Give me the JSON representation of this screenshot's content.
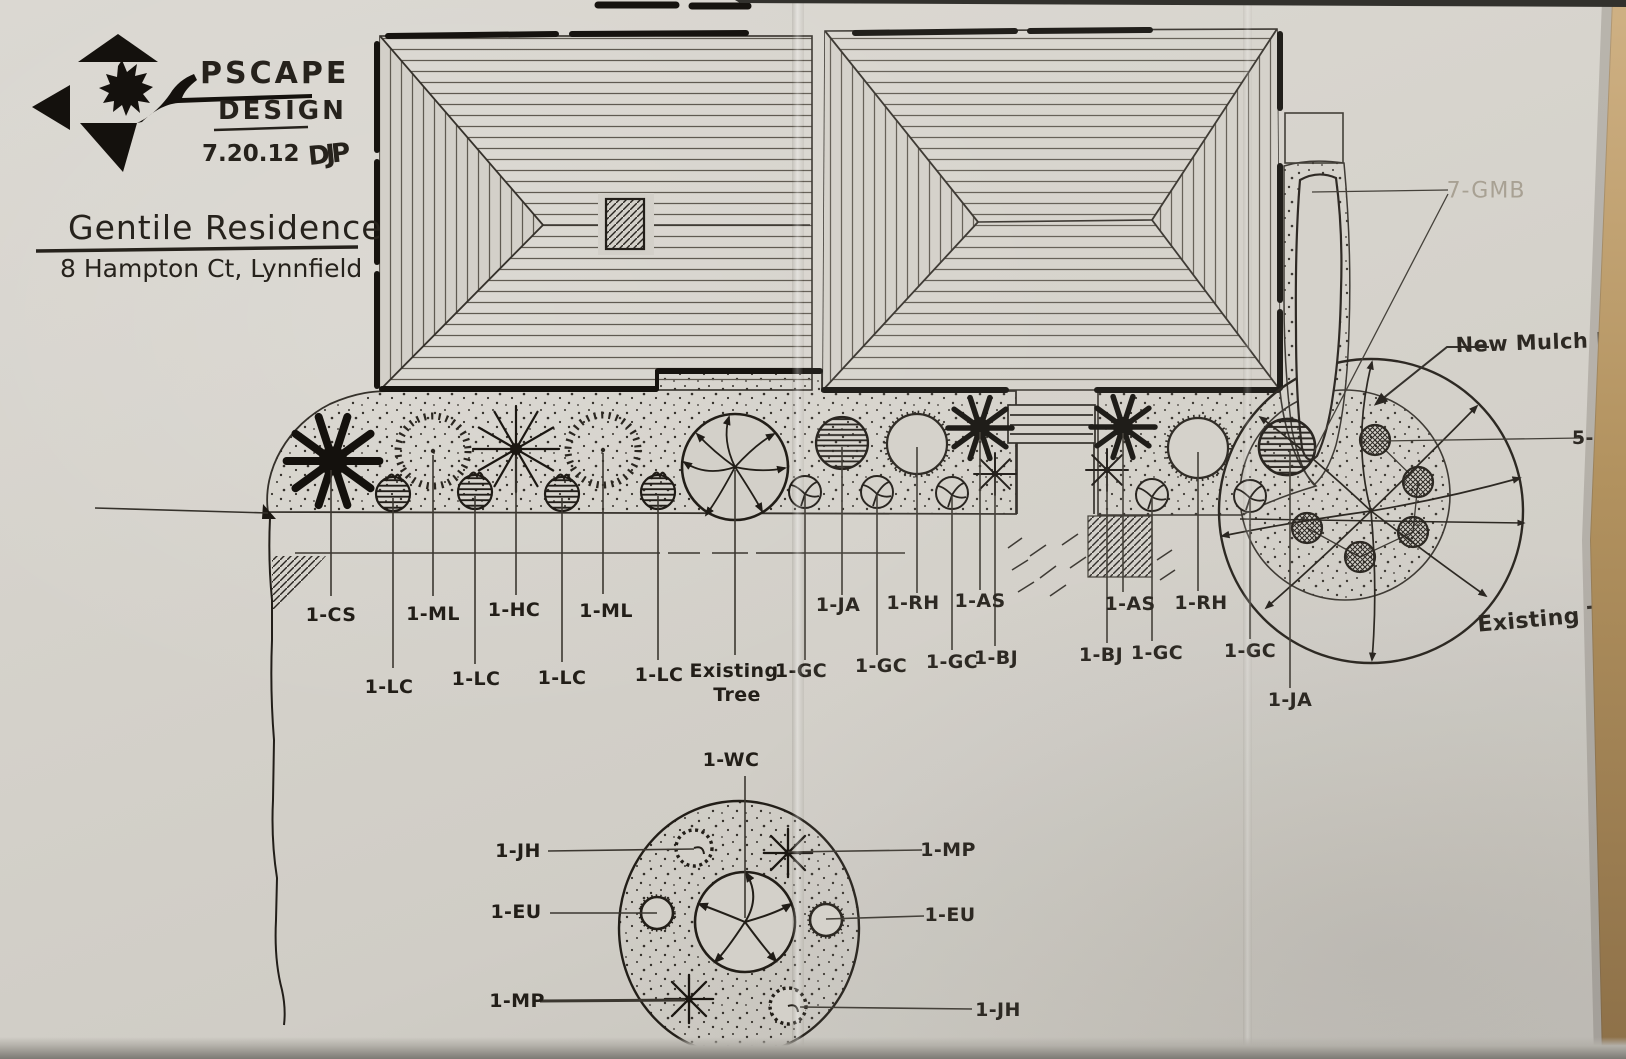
{
  "title_block": {
    "firm_name_line1": "PSCAPE",
    "firm_name_line2": "DESIGN",
    "date": "7.20.12",
    "designer_initials": "DJP",
    "project_name": "Gentile Residence",
    "project_address": "8 Hampton Ct, Lynnfield"
  },
  "plant_labels": {
    "cs": "1-CS",
    "lc": "1-LC",
    "ml": "1-ML",
    "hc": "1-HC",
    "ja": "1-JA",
    "rh": "1-RH",
    "as": "1-AS",
    "bj": "1-BJ",
    "gc": "1-GC",
    "wc": "1-WC",
    "jh": "1-JH",
    "eu": "1-EU",
    "mp": "1-MP",
    "gmb": "7-GMB",
    "hs": "5-HS"
  },
  "annotations": {
    "new_mulch_bed": "New Mulch Bed",
    "existing_word": "Existing",
    "tree_word": "Tree",
    "existing_tree": "Existing Tree"
  },
  "symbols": {
    "starburst-shrub-icon": [
      "1-CS",
      "1-AS"
    ],
    "thin-spiky-star-icon": [
      "1-BJ",
      "1-MP",
      "1-HC"
    ],
    "radial-tick-circle-icon": "1-ML",
    "hatched-circle-icon": [
      "1-LC",
      "1-JA"
    ],
    "fringed-circle-icon": [
      "1-RH",
      "1-EU"
    ],
    "segmented-tree-circle-icon": [
      "1-WC",
      "Existing Tree"
    ],
    "curved-spray-circle-icon": "1-GC",
    "dashed-spiral-circle-icon": "1-JH",
    "crosshatched-circle-icon": "5-HS",
    "stippled-area": "mulch bed",
    "hip-roof-hatch": "house roof plan"
  },
  "colors": {
    "ink": "#201c17",
    "pencil_gray": "#a49c8e",
    "paper": "#d3d0c9",
    "table_edge": "#9a7c50"
  }
}
